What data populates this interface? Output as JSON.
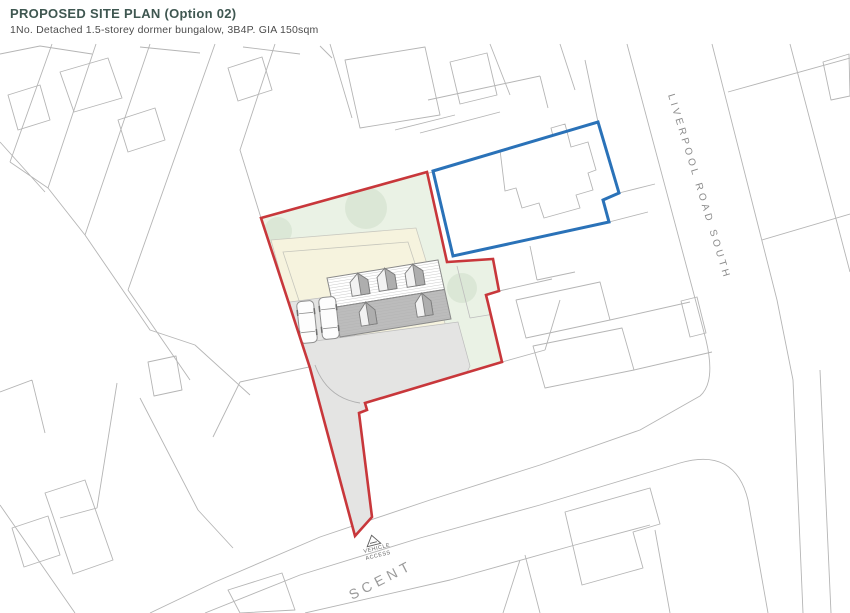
{
  "header": {
    "title": "PROPOSED SITE PLAN (Option 02)",
    "subtitle": "1No. Detached 1.5-storey dormer bungalow, 3B4P. GIA 150sqm"
  },
  "map": {
    "road_label": "LIVERPOOL ROAD SOUTH",
    "street_fragment_label": "SCENT",
    "vehicle_access": {
      "line1": "VEHICLE",
      "line2": "ACCESS"
    },
    "features": {
      "proposed_building": "1.5-storey dormer bungalow",
      "upper_dormer_count": 3,
      "lower_dormer_count": 2,
      "parked_cars": 2,
      "trees_in_site": 3
    },
    "colors": {
      "site_boundary_red": "#c8373b",
      "adjacent_boundary_blue": "#2a72b8",
      "site_greenspace": "#eaf2e5",
      "curtilage_cream": "#f6f3de",
      "driveway_grey": "#e4e4e3",
      "roof_grey": "#bcbcbc",
      "parcel_line_grey": "#b5b5b5",
      "tree_green": "#d8e5d3",
      "title_teal": "#3f5751"
    }
  }
}
